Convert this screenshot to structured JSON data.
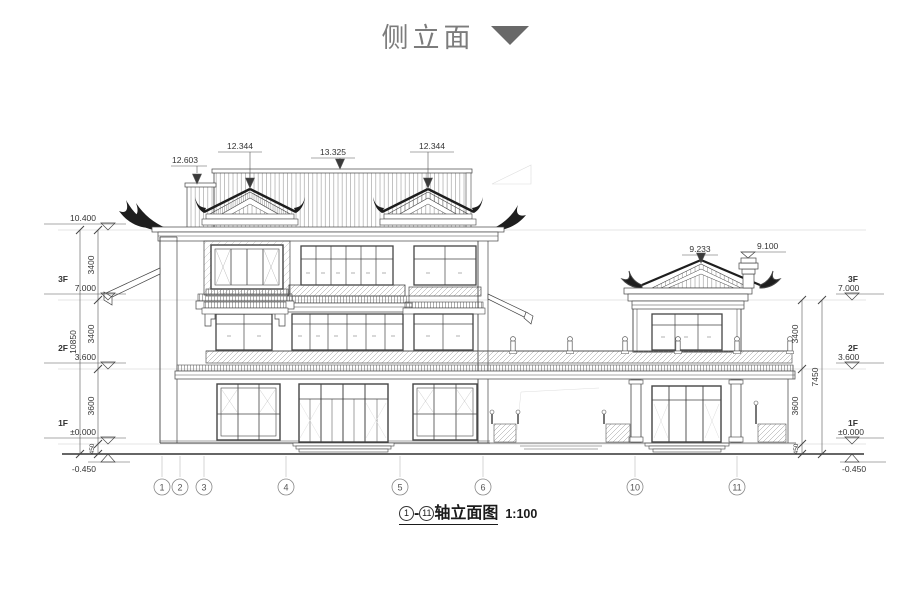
{
  "header": {
    "title": "侧立面"
  },
  "caption": {
    "axis_from": "1",
    "axis_to": "11",
    "title": "轴立面图",
    "scale": "1:100"
  },
  "drawing": {
    "top_labels": {
      "left_block": "12.603",
      "left_dormer": "12.344",
      "ridge": "13.325",
      "right_dormer": "12.344"
    },
    "right_roof": {
      "ridge": "9.233",
      "chimney": "9.100"
    },
    "levels_left": [
      {
        "floor": "",
        "elev": "10.400"
      },
      {
        "floor": "3F",
        "elev": "7.000"
      },
      {
        "floor": "2F",
        "elev": "3.600"
      },
      {
        "floor": "1F",
        "elev": "±0.000"
      },
      {
        "floor": "",
        "elev": "-0.450"
      }
    ],
    "levels_right": [
      {
        "floor": "3F",
        "elev": "7.000"
      },
      {
        "floor": "2F",
        "elev": "3.600"
      },
      {
        "floor": "1F",
        "elev": "±0.000"
      },
      {
        "floor": "",
        "elev": "-0.450"
      }
    ],
    "dims_left": {
      "a": "3400",
      "b": "3400",
      "c": "3600",
      "d": "450",
      "total": "10850"
    },
    "dims_right": {
      "a": "3400",
      "b": "3600",
      "c": "450",
      "total": "7450"
    },
    "axes": [
      "1",
      "2",
      "3",
      "4",
      "5",
      "6",
      "10",
      "11"
    ]
  }
}
